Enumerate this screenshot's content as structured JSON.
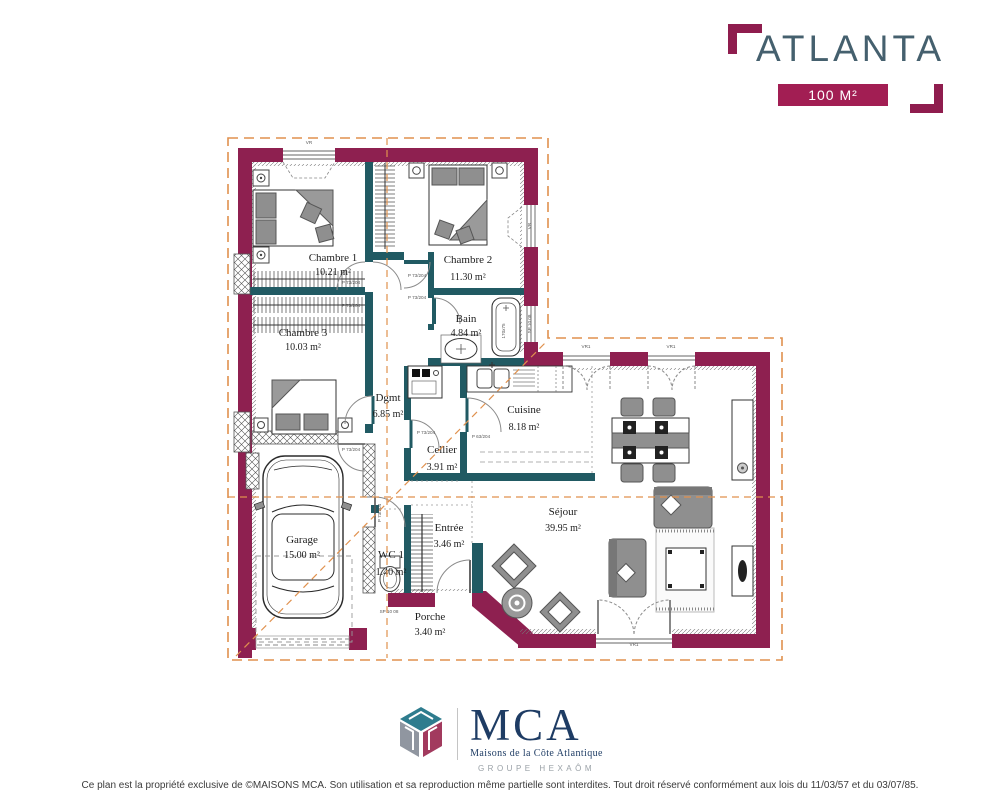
{
  "header": {
    "title": "ATLANTA",
    "area_badge": "100 M²"
  },
  "plan": {
    "rooms": [
      {
        "name": "Chambre 1",
        "area": "10.21 m²"
      },
      {
        "name": "Chambre 2",
        "area": "11.30 m²"
      },
      {
        "name": "Chambre 3",
        "area": "10.03 m²"
      },
      {
        "name": "Bain",
        "area": "4.84 m²"
      },
      {
        "name": "Dgmt",
        "area": "6.85 m²"
      },
      {
        "name": "Cuisine",
        "area": "8.18 m²"
      },
      {
        "name": "Cellier",
        "area": "3.91 m²"
      },
      {
        "name": "Séjour",
        "area": "39.95 m²"
      },
      {
        "name": "Garage",
        "area": "15.00 m²"
      },
      {
        "name": "WC 1",
        "area": "1.40 m²"
      },
      {
        "name": "Entrée",
        "area": "3.46 m²"
      },
      {
        "name": "Porche",
        "area": "3.40 m²"
      }
    ],
    "labels": {
      "vr_top": "VR",
      "vr_ch2": "VR",
      "vr1_a": "VR1",
      "vr1_b": "VR1",
      "vr1_door": "VR1",
      "sp_bain": "SP 10 08",
      "sp_porch": "SP 10 08",
      "tub_size": "170x75",
      "door_ch1_a": "P 73/204",
      "door_ch1_b": "P 73/204",
      "door_ch2_a": "P 73/204",
      "door_ch2_b": "P 73/204",
      "door_cellier": "P 73/204",
      "door_cuisine": "P 63/204",
      "door_garage": "P 73/204",
      "door_garage_side": "P 73/204"
    },
    "colors": {
      "wall": "#8e2050",
      "partition": "#215a63",
      "roof_dash": "#e0914e"
    }
  },
  "footer": {
    "brand": "MCA",
    "tagline": "Maisons de la Côte Atlantique",
    "group": "GROUPE HEXAÔM",
    "copyright": "Ce plan est la propriété exclusive de ©MAISONS MCA. Son utilisation et sa reproduction même partielle sont interdites. Tout droit réservé conformément aux lois du 11/03/57 et du 03/07/85."
  }
}
